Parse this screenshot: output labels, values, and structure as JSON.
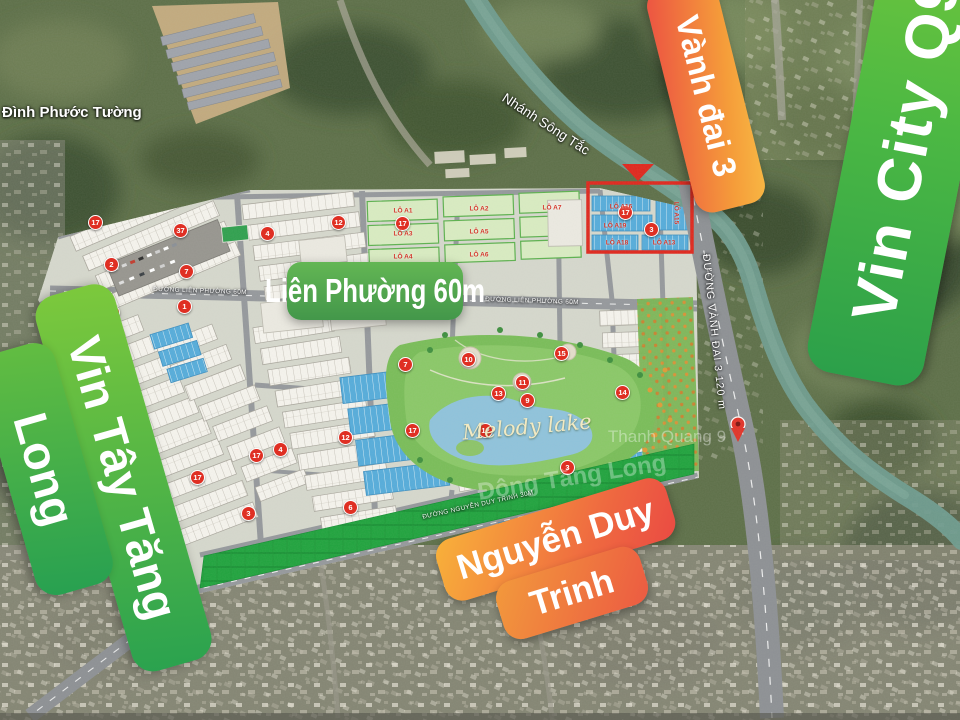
{
  "banners": {
    "ring_road": "Vành đai 3",
    "vin_city": "Vin City Q9",
    "vin_tay_line1": "Vin Tây Tăng",
    "vin_tay_line2": "Long",
    "lien_phuong": "Liên Phường 60m",
    "nguyen_duy_line1": "Nguyễn Duy",
    "nguyen_duy_line2": "Trinh"
  },
  "map_labels": {
    "temple": "Đình Phước Tường",
    "river": "Nhánh Sông Tắc",
    "ring_road_street": "ĐƯỜNG VÀNH ĐAI 3  120 m",
    "lien_phuong_street": "ĐƯỜNG LIÊN PHƯỜNG 60M",
    "nguyen_duy_street": "ĐƯỜNG NGUYỄN DUY TRINH 30M",
    "lake": "Melody lake",
    "watermark_1": "Thanh Quang 9",
    "watermark_2": "Đông Tăng Long"
  },
  "markers": [
    {
      "x": 95,
      "y": 222,
      "n": "17"
    },
    {
      "x": 180,
      "y": 230,
      "n": "37"
    },
    {
      "x": 267,
      "y": 233,
      "n": "4"
    },
    {
      "x": 338,
      "y": 222,
      "n": "12"
    },
    {
      "x": 111,
      "y": 264,
      "n": "2"
    },
    {
      "x": 186,
      "y": 271,
      "n": "7"
    },
    {
      "x": 184,
      "y": 306,
      "n": "1"
    },
    {
      "x": 112,
      "y": 312,
      "n": "8"
    },
    {
      "x": 402,
      "y": 223,
      "n": "17"
    },
    {
      "x": 625,
      "y": 212,
      "n": "17"
    },
    {
      "x": 651,
      "y": 229,
      "n": "3"
    },
    {
      "x": 405,
      "y": 364,
      "n": "7"
    },
    {
      "x": 468,
      "y": 359,
      "n": "10"
    },
    {
      "x": 561,
      "y": 353,
      "n": "15"
    },
    {
      "x": 522,
      "y": 382,
      "n": "11"
    },
    {
      "x": 498,
      "y": 393,
      "n": "13"
    },
    {
      "x": 527,
      "y": 400,
      "n": "9"
    },
    {
      "x": 622,
      "y": 392,
      "n": "14"
    },
    {
      "x": 485,
      "y": 430,
      "n": "12"
    },
    {
      "x": 412,
      "y": 430,
      "n": "17"
    },
    {
      "x": 567,
      "y": 467,
      "n": "3"
    },
    {
      "x": 256,
      "y": 455,
      "n": "17"
    },
    {
      "x": 197,
      "y": 477,
      "n": "17"
    },
    {
      "x": 248,
      "y": 513,
      "n": "3"
    },
    {
      "x": 350,
      "y": 507,
      "n": "6"
    },
    {
      "x": 345,
      "y": 437,
      "n": "12"
    },
    {
      "x": 280,
      "y": 449,
      "n": "4"
    }
  ],
  "lot_labels": [
    {
      "x": 621,
      "y": 207,
      "t": "LÔ A16",
      "r": 0
    },
    {
      "x": 615,
      "y": 226,
      "t": "LÔ A19",
      "r": 0
    },
    {
      "x": 617,
      "y": 243,
      "t": "LÔ A18",
      "r": 0
    },
    {
      "x": 664,
      "y": 243,
      "t": "LÔ A13",
      "r": 0
    },
    {
      "x": 676,
      "y": 213,
      "t": "LÔ A15",
      "r": 90
    },
    {
      "x": 403,
      "y": 211,
      "t": "LÔ A1",
      "r": 0
    },
    {
      "x": 479,
      "y": 209,
      "t": "LÔ A2",
      "r": 0
    },
    {
      "x": 403,
      "y": 234,
      "t": "LÔ A3",
      "r": 0
    },
    {
      "x": 479,
      "y": 232,
      "t": "LÔ A5",
      "r": 0
    },
    {
      "x": 403,
      "y": 257,
      "t": "LÔ A4",
      "r": 0
    },
    {
      "x": 479,
      "y": 255,
      "t": "LÔ A6",
      "r": 0
    },
    {
      "x": 552,
      "y": 208,
      "t": "LÔ A7",
      "r": 0
    }
  ],
  "colors": {
    "banner_green_light": "#7cc93c",
    "banner_green_dark": "#2aa04c",
    "banner_orange_light": "#f8b43a",
    "banner_orange_red": "#ea4c41",
    "highlight_red": "#e0261c",
    "lot_blue": "#55acdb",
    "park_green": "#1fa33d",
    "lake_blue": "#8fc3dc",
    "river_teal": "#6f9c8f"
  }
}
